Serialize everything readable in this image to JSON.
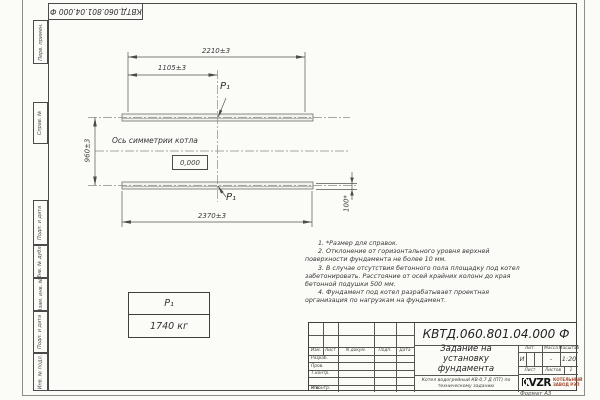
{
  "sheet": {
    "corner_stamp_code": "КВТД.060.801.04.000  Ф",
    "format_label": "Формат А3"
  },
  "margin_columns": {
    "perv_primen": "Перв. примен.",
    "sprav_no": "Справ. №",
    "podp_data_1": "Подп. и дата",
    "inv_dubl": "Инв. № дубл.",
    "vzam_inv": "Взам. инв. №",
    "podp_data_2": "Подп. и дата",
    "inv_podl": "Инв. № подл."
  },
  "drawing": {
    "dim_top_overall": "2210±3",
    "dim_top_half": "1105±3",
    "dim_side_height": "960±3",
    "dim_bottom_overall": "2370±3",
    "dim_ref_height": "100*",
    "axis_label": "Ось симметрии котла",
    "level_mark": "0,000",
    "load_point_top": "P₁",
    "load_point_bottom": "P₁"
  },
  "weight_table": {
    "header": "P₁",
    "value": "1740 кг"
  },
  "notes": [
    "1. *Размер для справок.",
    "2. Отклонение от горизонтального уровня верхней поверхности фундамента не более 10 мм.",
    "3. В случае отсутствия бетонного пола площадку под котел забетонировать. Расстояние от осей крайних колонн до края бетонной подушки 500 мм.",
    "4. Фундамент под котел разрабатывает проектная организация по нагрузкам на фундамент."
  ],
  "title_block": {
    "doc_number": "КВТД.060.801.04.000  Ф",
    "title": "Задание на установку фундамента",
    "product": "Котел водогрейный КВ-0,7 Д (ПТ) по техническому заданию",
    "col_izm": "Изм.",
    "col_list": "Лист",
    "col_ndokum": "N докум.",
    "col_podp": "Подп.",
    "col_data": "Дата",
    "row_razrab": "Разраб.",
    "row_prov": "Пров.",
    "row_tkontr": "Т.контр.",
    "row_nkontr": "Н.контр.",
    "row_utv": "Утв.",
    "lit_header": "Лит.",
    "lit_value": "И",
    "mass_header": "Масса",
    "mass_value": "-",
    "scale_header": "Масштаб",
    "scale_value": "1:20",
    "sheet_header": "Лист",
    "sheets_header": "Листов",
    "sheets_value": "1",
    "logo_text": "KVZR",
    "company_line1": "КОТЕЛЬНЫЙ",
    "company_line2": "ЗАВОД РЭП"
  }
}
